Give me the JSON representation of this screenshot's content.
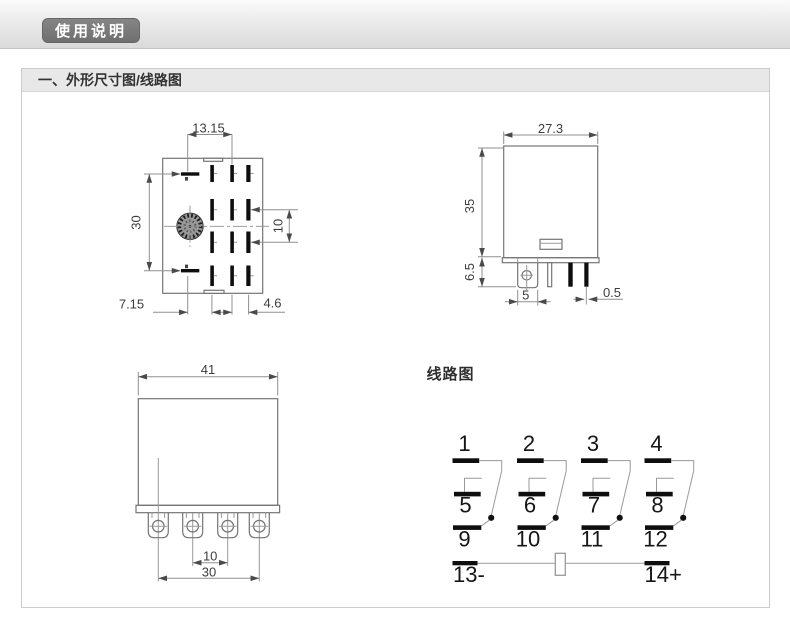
{
  "page": {
    "badge_label": "使用说明",
    "section_title": "一、外形尺寸图/线路图"
  },
  "drawings": {
    "bottom_view": {
      "dim_top_width": "13.15",
      "dim_left_height": "30",
      "dim_right_pitch": "10",
      "dim_bottom_left": "7.15",
      "dim_bottom_right": "4.6"
    },
    "side_view": {
      "dim_width": "27.3",
      "dim_height": "35",
      "dim_pin_height": "6.5",
      "dim_tab_width": "5",
      "dim_pin_thickness": "0.5"
    },
    "front_view": {
      "dim_width": "41",
      "dim_pin_pitch": "10",
      "dim_pin_span": "30"
    },
    "circuit": {
      "title": "线路图",
      "pins_top": [
        "1",
        "2",
        "3",
        "4"
      ],
      "pins_mid": [
        "5",
        "6",
        "7",
        "8"
      ],
      "pins_bottom": [
        "9",
        "10",
        "11",
        "12"
      ],
      "pin_coil_neg": "13-",
      "pin_coil_pos": "14+"
    }
  },
  "colors": {
    "badge_background": "#7a7a7a",
    "panel_header_background": "#e8e8e8",
    "drawing_line": "#8a8a8a",
    "contact_bar": "#0e0e0e"
  }
}
